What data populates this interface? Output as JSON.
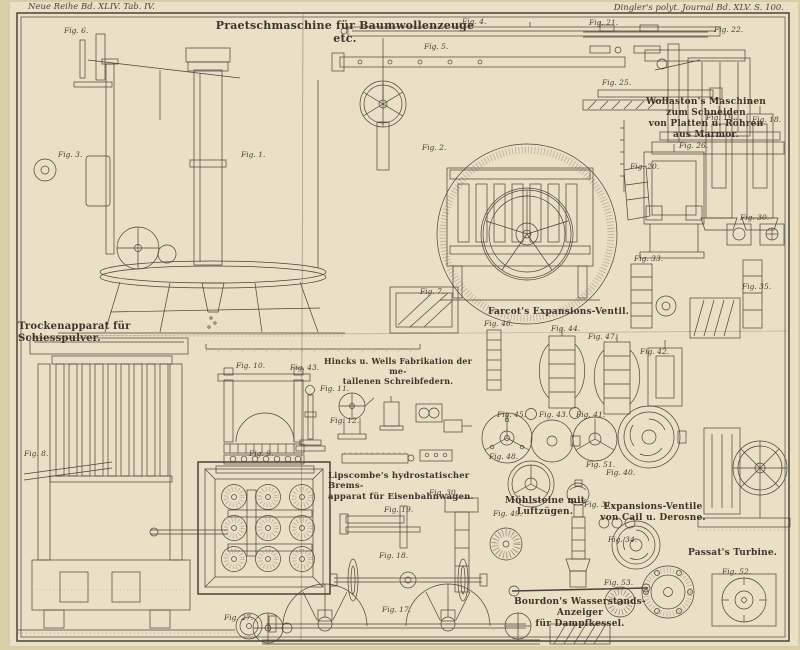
{
  "page": {
    "header_left": "Neue Reihe Bd. XLIV. Tab. IV.",
    "header_right": "Dingler's polyt. Journal Bd. XLV. S. 100."
  },
  "colors": {
    "paper": "#e9e0c6",
    "margin": "#d9cda8",
    "ink": "#4a4339",
    "dark_fill": "#6f6757"
  },
  "section_titles": [
    {
      "text": "Praetschmaschine für Baumwollenzeuge etc.",
      "x": 205,
      "y": 19,
      "w": 280,
      "size": 11,
      "align": "center"
    },
    {
      "text": "Wollaston's Maschinen\nzum Schneiden\nvon Platten u. Röhren\naus Marmor.",
      "x": 636,
      "y": 97,
      "w": 140,
      "size": 9,
      "align": "center"
    },
    {
      "text": "Trockenapparat für Schiesspulver.",
      "x": 18,
      "y": 321,
      "w": 195,
      "size": 10,
      "align": "left"
    },
    {
      "text": "Farcot's Expansions-Ventil.",
      "x": 486,
      "y": 307,
      "w": 145,
      "size": 9,
      "align": "center"
    },
    {
      "text": "Hincks u. Wells Fabrikation der me-\ntallenen Schreibfedern.",
      "x": 322,
      "y": 357,
      "w": 152,
      "size": 8,
      "align": "center"
    },
    {
      "text": "Lipscombe's hydrostatischer Brems-\napparat für Eisenbahnwagen.",
      "x": 328,
      "y": 471,
      "w": 162,
      "size": 8.5,
      "align": "left"
    },
    {
      "text": "Mühlsteine mit\nLuftzügen.",
      "x": 500,
      "y": 496,
      "w": 90,
      "size": 9,
      "align": "center"
    },
    {
      "text": "Expansions-Ventile\nvon Cail u. Derosne.",
      "x": 592,
      "y": 502,
      "w": 122,
      "size": 9,
      "align": "center"
    },
    {
      "text": "Passat's Turbine.",
      "x": 688,
      "y": 548,
      "w": 100,
      "size": 9,
      "align": "left"
    },
    {
      "text": "Bourdon's Wasserstands-Anzeiger\nfür Dampfkessel.",
      "x": 496,
      "y": 597,
      "w": 168,
      "size": 9,
      "align": "center"
    }
  ],
  "figure_labels": [
    {
      "text": "Fig. 6.",
      "x": 64,
      "y": 26
    },
    {
      "text": "Fig. 4.",
      "x": 462,
      "y": 17
    },
    {
      "text": "Fig. 5.",
      "x": 424,
      "y": 42
    },
    {
      "text": "Fig. 21.",
      "x": 589,
      "y": 18
    },
    {
      "text": "Fig. 22.",
      "x": 714,
      "y": 25
    },
    {
      "text": "Fig. 25.",
      "x": 602,
      "y": 78
    },
    {
      "text": "Fig. 3.",
      "x": 58,
      "y": 150
    },
    {
      "text": "Fig. 1.",
      "x": 241,
      "y": 150
    },
    {
      "text": "Fig. 2.",
      "x": 422,
      "y": 143
    },
    {
      "text": "Fig. 19.",
      "x": 706,
      "y": 113
    },
    {
      "text": "Fig. 18.",
      "x": 752,
      "y": 115
    },
    {
      "text": "Fig. 26.",
      "x": 679,
      "y": 141
    },
    {
      "text": "Fig. 20.",
      "x": 630,
      "y": 162
    },
    {
      "text": "Fig. 30.",
      "x": 740,
      "y": 213
    },
    {
      "text": "Fig. 33.",
      "x": 634,
      "y": 254
    },
    {
      "text": "Fig. 35.",
      "x": 742,
      "y": 282
    },
    {
      "text": "Fig. 7.",
      "x": 420,
      "y": 287
    },
    {
      "text": "Fig. 46.",
      "x": 484,
      "y": 319
    },
    {
      "text": "Fig. 44.",
      "x": 551,
      "y": 324
    },
    {
      "text": "Fig. 47.",
      "x": 588,
      "y": 332
    },
    {
      "text": "Fig. 42.",
      "x": 640,
      "y": 347
    },
    {
      "text": "Fig. 45.",
      "x": 497,
      "y": 410
    },
    {
      "text": "Fig. 43.",
      "x": 539,
      "y": 410
    },
    {
      "text": "Fig. 41.",
      "x": 576,
      "y": 410
    },
    {
      "text": "Fig. 48.",
      "x": 489,
      "y": 452
    },
    {
      "text": "Fig. 51.",
      "x": 586,
      "y": 460
    },
    {
      "text": "Fig. 40.",
      "x": 606,
      "y": 468
    },
    {
      "text": "Fig. 49.",
      "x": 493,
      "y": 509
    },
    {
      "text": "Fig. 31.",
      "x": 584,
      "y": 500
    },
    {
      "text": "Fig. 34.",
      "x": 608,
      "y": 535
    },
    {
      "text": "Fig. 52.",
      "x": 722,
      "y": 567
    },
    {
      "text": "Fig. 53.",
      "x": 604,
      "y": 578
    },
    {
      "text": "Fig. 10.",
      "x": 236,
      "y": 361
    },
    {
      "text": "Fig. 43.",
      "x": 290,
      "y": 363
    },
    {
      "text": "Fig. 11.",
      "x": 320,
      "y": 384
    },
    {
      "text": "Fig. 12.",
      "x": 330,
      "y": 416
    },
    {
      "text": "Fig. 9.",
      "x": 249,
      "y": 449
    },
    {
      "text": "Fig. 8.",
      "x": 24,
      "y": 449
    },
    {
      "text": "Fig. 30.",
      "x": 429,
      "y": 488
    },
    {
      "text": "Fig. 19.",
      "x": 384,
      "y": 505
    },
    {
      "text": "Fig. 18.",
      "x": 379,
      "y": 551
    },
    {
      "text": "Fig. 17.",
      "x": 382,
      "y": 605
    },
    {
      "text": "Fig. 27.",
      "x": 224,
      "y": 613
    }
  ]
}
